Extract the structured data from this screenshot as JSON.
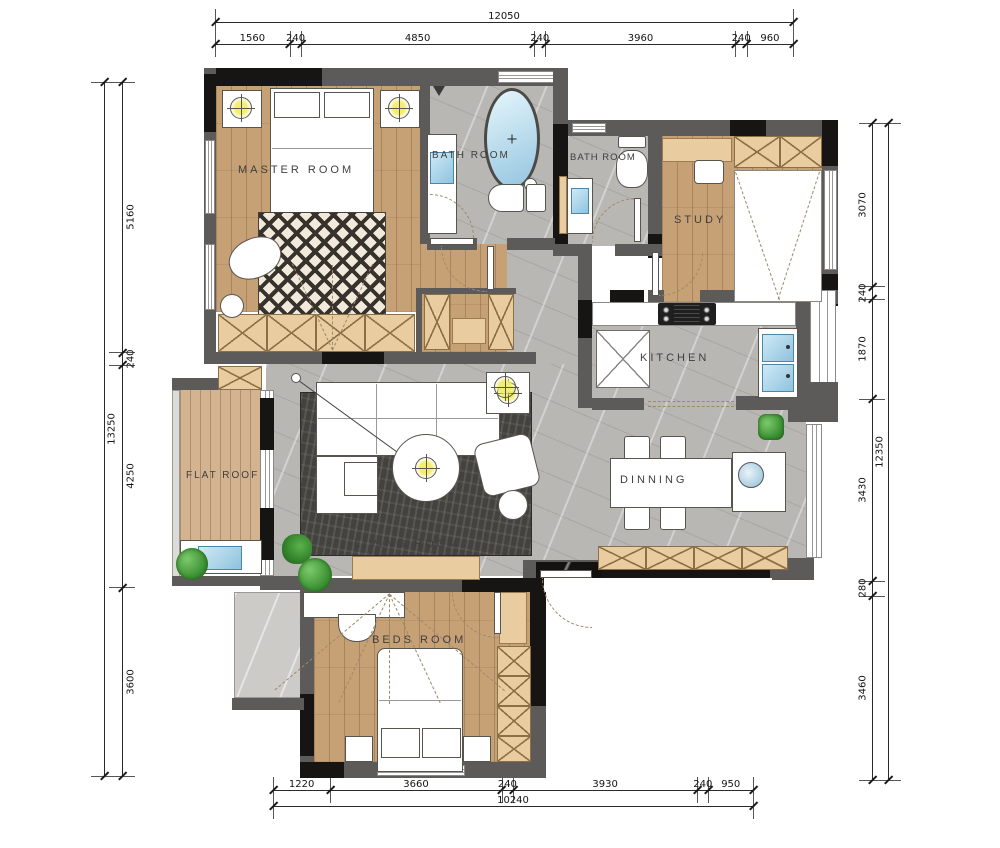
{
  "plan": {
    "rooms": {
      "master": "MASTER ROOM",
      "bath1": "BATH ROOM",
      "bath2": "BATH ROOM",
      "study": "STUDY",
      "kitchen": "KITCHEN",
      "dinning": "DINNING",
      "living": "LIVING ROOM",
      "flat_roof": "FLAT ROOF",
      "beds": "BEDS ROOM"
    }
  },
  "dimensions": {
    "top": {
      "total": 12050,
      "segments": [
        1560,
        240,
        4850,
        240,
        3960,
        240,
        960
      ]
    },
    "bottom": {
      "total": 10240,
      "segments": [
        1220,
        3660,
        240,
        3930,
        240,
        950
      ]
    },
    "left": {
      "total": 13250,
      "segments": [
        5160,
        240,
        4250,
        3600
      ]
    },
    "right": {
      "total": 12350,
      "segments": [
        3070,
        240,
        1870,
        3430,
        280,
        3460
      ]
    }
  },
  "colors": {
    "wall_gray": "#5d5b59",
    "wall_black": "#161513",
    "wood_floor": "#c7a176",
    "deck_wood": "#d4b390",
    "tile_gray": "#b9b7b4",
    "cabinet_tan": "#e9cda1",
    "rug_dark": "#44423e",
    "water_blue": "#a8d4e8",
    "lamp_yellow": "#f0ea5a",
    "plant_green": "#46a13c"
  }
}
